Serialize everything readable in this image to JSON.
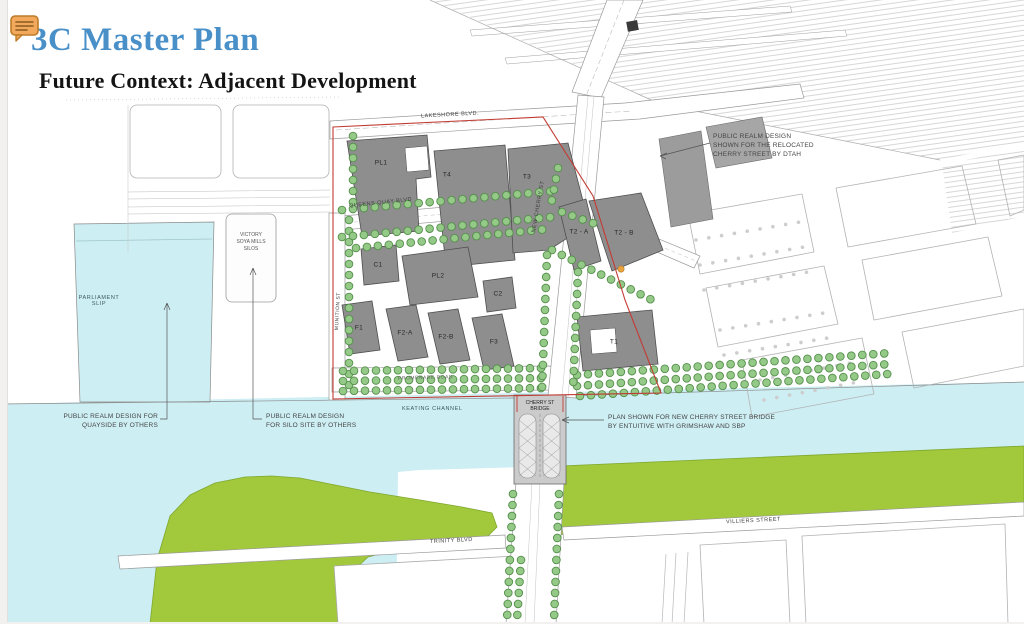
{
  "slide": {
    "title": "3C Master Plan",
    "subtitle": "Future Context: Adjacent Development",
    "title_color": "#4a90c8"
  },
  "icons": {
    "comment_note": "speech-bubble-with-text-lines"
  },
  "map": {
    "streets": [
      {
        "id": "lakeshore",
        "label": "LAKESHORE BLVD."
      },
      {
        "id": "queens_quay",
        "label": "QUEENS QUAY BLVD"
      },
      {
        "id": "new_cherry",
        "label": "NEW CHERRY ST"
      },
      {
        "id": "munition",
        "label": "MUNITION ST"
      },
      {
        "id": "promenade",
        "label": "PROMENADE ROAD"
      },
      {
        "id": "trinity",
        "label": "TRINITY BLVD"
      },
      {
        "id": "villiers",
        "label": "VILLIERS STREET"
      }
    ],
    "water": [
      {
        "id": "keating",
        "label": "KEATING CHANNEL"
      },
      {
        "id": "parliament_slip",
        "label": "PARLIAMENT\nSLIP"
      }
    ],
    "landmarks": [
      {
        "id": "silos",
        "label": "VICTORY\nSOYA MILLS\nSILOS"
      },
      {
        "id": "bridge",
        "label": "CHERRY ST\nBRIDGE"
      }
    ],
    "buildings": [
      {
        "label": "PL1"
      },
      {
        "label": "T4"
      },
      {
        "label": "T3"
      },
      {
        "label": "C1"
      },
      {
        "label": "PL2"
      },
      {
        "label": "C2"
      },
      {
        "label": "F1"
      },
      {
        "label": "F2-A"
      },
      {
        "label": "F2-B"
      },
      {
        "label": "F3"
      },
      {
        "label": "T1"
      },
      {
        "label": "T2 - A"
      },
      {
        "label": "T2 - B"
      }
    ],
    "annotations": [
      {
        "id": "dtah",
        "text": "PUBLIC REALM DESIGN\nSHOWN FOR THE RELOCATED\nCHERRY STREET BY DTAH"
      },
      {
        "id": "quayside",
        "text": "PUBLIC REALM DESIGN FOR\nQUAYSIDE BY OTHERS"
      },
      {
        "id": "silo_site",
        "text": "PUBLIC REALM DESIGN\nFOR SILO SITE BY OTHERS"
      },
      {
        "id": "bridge_credit",
        "text": "PLAN SHOWN FOR NEW CHERRY STREET BRIDGE\nBY ENTUITIVE WITH GRIMSHAW AND SBP"
      }
    ],
    "colors": {
      "water": "#cdeef3",
      "park": "#a2c83b",
      "building": "#8e8e8e",
      "site_boundary": "#c23b33",
      "tree": "#94c987",
      "highlight_dot": "#e8a33d"
    }
  }
}
